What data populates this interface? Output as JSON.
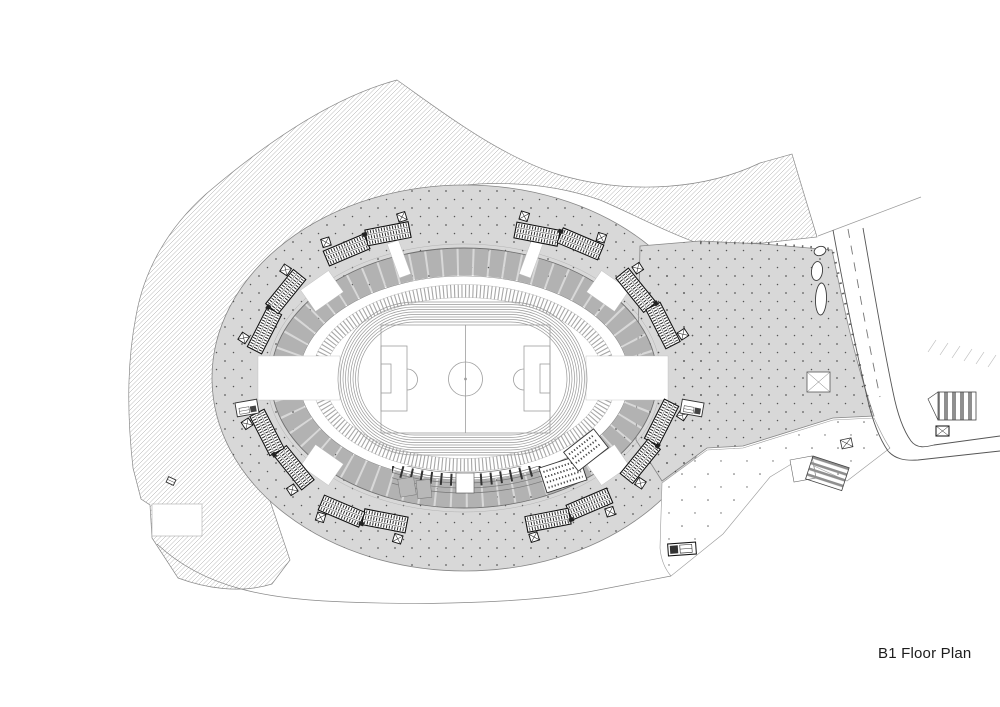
{
  "page": {
    "width": 1000,
    "height": 707,
    "background": "#ffffff"
  },
  "titleblock": {
    "title": "B1 Floor Plan",
    "color": "#1c1c1c"
  },
  "plan": {
    "type": "architectural-floor-plan",
    "level": "B1",
    "features": [
      "landscape-hatch-area",
      "concourse-deck-with-dot-grid",
      "east-plaza",
      "access-road-with-lane-dashes",
      "stadium-stand-ring-segmented",
      "inner-seating-tick-ring",
      "running-track-8-lanes",
      "soccer-field-with-markings",
      "south-stand-rows-and-tunnel",
      "southeast-bleacher-blocks",
      "ramp-stair-clusters-x8",
      "kiosk-west",
      "kiosk-east",
      "service-vehicle",
      "east-stair-crossing",
      "southeast-stair-crossing",
      "ramp-markers-with-x",
      "planting-blobs",
      "site-boundary-lines"
    ],
    "colors": {
      "concourse_fill": "#d8d8d8",
      "stand_segment": "#b2b2b2",
      "hatch_line": "#9a9a9a",
      "dot_grid": "#555555",
      "line_dark": "#2a2a2a",
      "line_mid": "#777777",
      "line_light": "#aaaaaa"
    }
  }
}
